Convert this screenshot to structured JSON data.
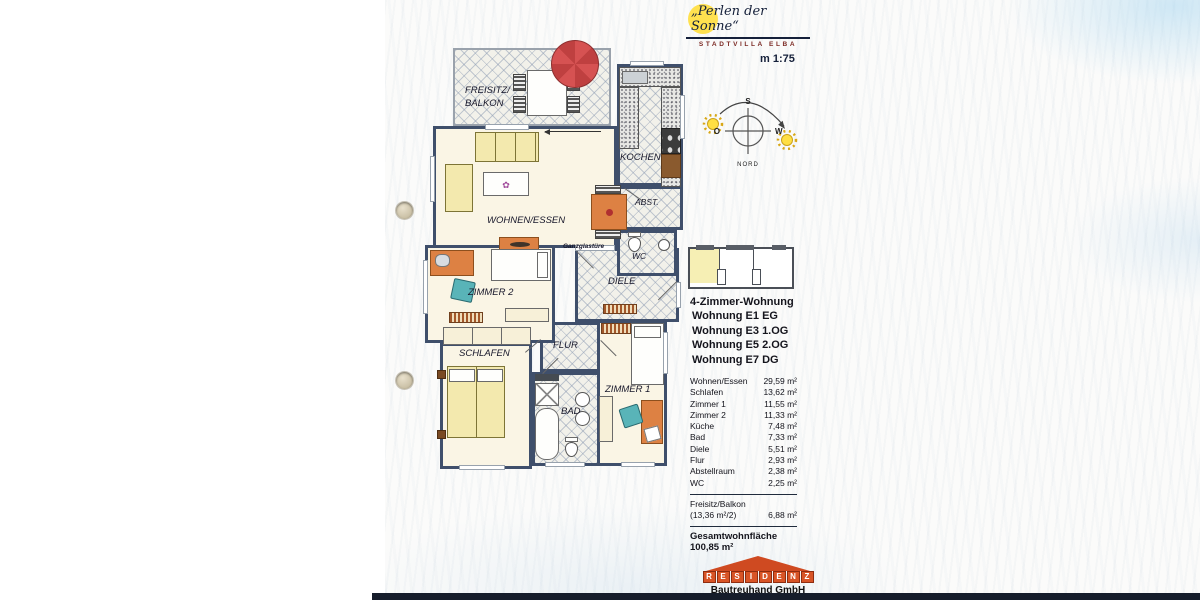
{
  "page": {
    "scale_label": "m 1:75"
  },
  "brand": {
    "title": "„Perlen der Sonne“",
    "subtitle": "STADTVILLA ELBA"
  },
  "compass": {
    "south": "S",
    "east": "O",
    "west": "W",
    "north": "NORD"
  },
  "plan": {
    "labels": {
      "balcony_line1": "FREISITZ/",
      "balcony_line2": "BALKON",
      "living": "WOHNEN/ESSEN",
      "kitchen": "KOCHEN",
      "storage": "ABST.",
      "wc": "WC",
      "hall": "DIELE",
      "glass_door": "Ganzglastüre",
      "room2": "ZIMMER 2",
      "bedroom": "SCHLAFEN",
      "corridor": "FLUR",
      "bath": "BAD",
      "room1": "ZIMMER 1"
    }
  },
  "apartment": {
    "type": "4-Zimmer-Wohnung",
    "units": [
      "Wohnung E1 EG",
      "Wohnung E3 1.OG",
      "Wohnung E5 2.OG",
      "Wohnung E7 DG"
    ]
  },
  "areas": {
    "rows": [
      {
        "label": "Wohnen/Essen",
        "value": "29,59 m²"
      },
      {
        "label": "Schlafen",
        "value": "13,62 m²"
      },
      {
        "label": "Zimmer 1",
        "value": "11,55 m²"
      },
      {
        "label": "Zimmer 2",
        "value": "11,33 m²"
      },
      {
        "label": "Küche",
        "value": "7,48 m²"
      },
      {
        "label": "Bad",
        "value": "7,33 m²"
      },
      {
        "label": "Diele",
        "value": "5,51 m²"
      },
      {
        "label": "Flur",
        "value": "2,93 m²"
      },
      {
        "label": "Abstellraum",
        "value": "2,38 m²"
      },
      {
        "label": "WC",
        "value": "2,25 m²"
      }
    ],
    "balcony": {
      "label": "Freisitz/Balkon",
      "detail": "(13,36 m²/2)",
      "value": "6,88 m²"
    },
    "total": "Gesamtwohnfläche 100,85 m²"
  },
  "footer": {
    "letters": [
      "R",
      "E",
      "S",
      "I",
      "D",
      "E",
      "N",
      "Z"
    ],
    "company": "Bautreuhand GmbH"
  },
  "colors": {
    "wall": "#3f4f6b",
    "accent_orange": "#dd8143",
    "accent_teal": "#59b4b8",
    "umbrella_red": "#d65252",
    "sun_yellow": "#ffe14f",
    "logo_red": "#cf4a21"
  }
}
